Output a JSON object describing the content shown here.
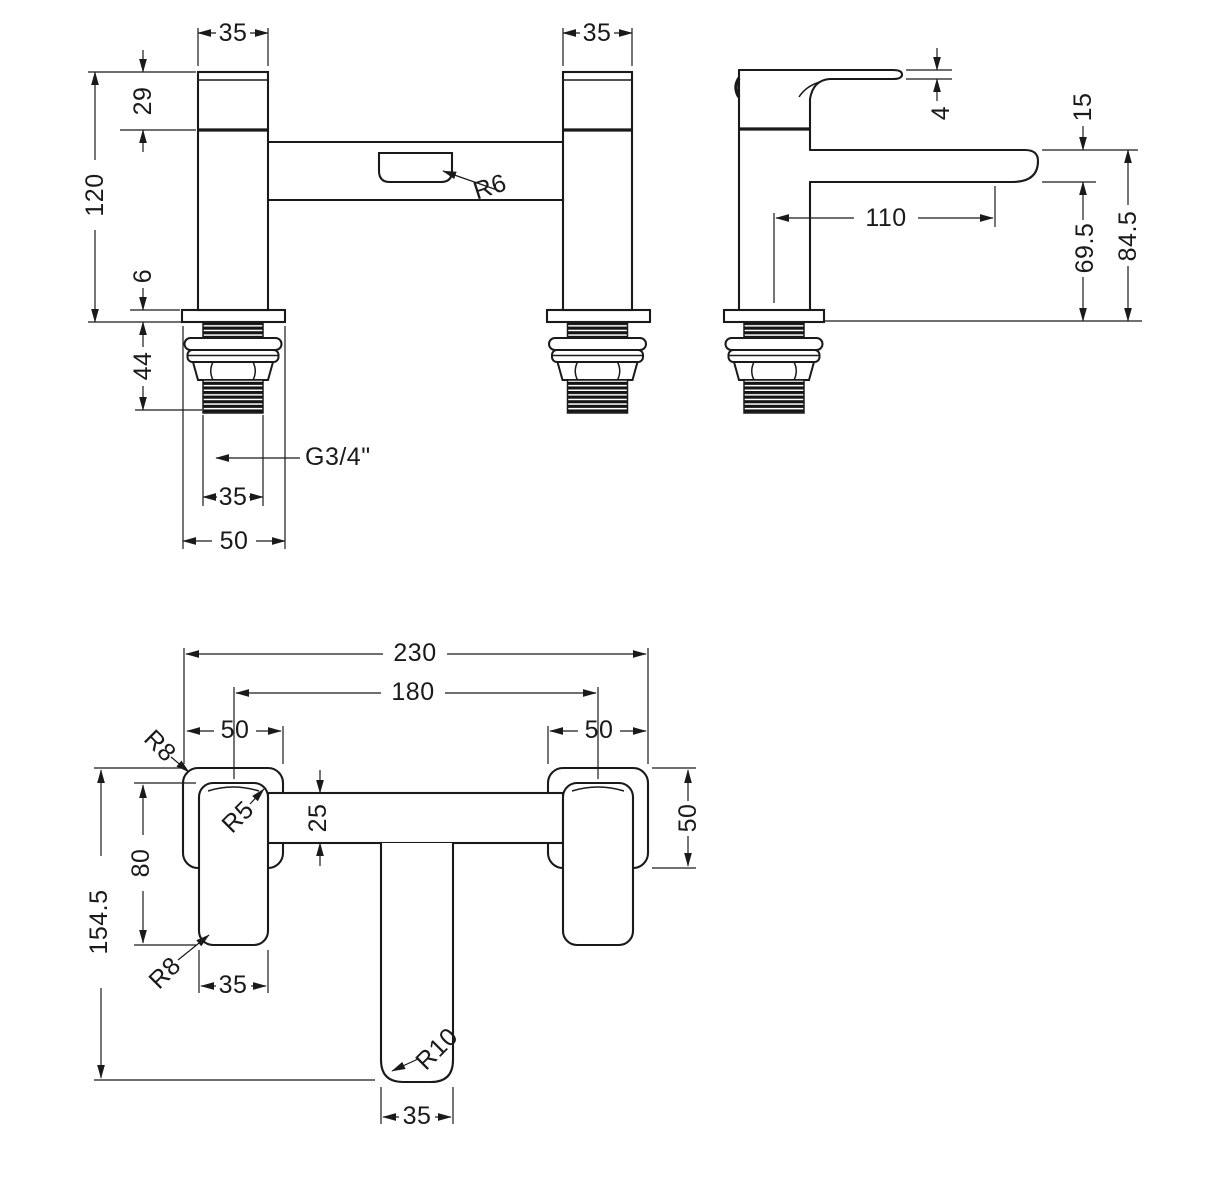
{
  "colors": {
    "ink": "#1a1a1a",
    "paper": "#ffffff"
  },
  "front": {
    "w_left": "35",
    "w_right": "35",
    "h_handle": "29",
    "h_body": "120",
    "t_flange": "6",
    "l_tail": "44",
    "thread_spec": "G3/4\"",
    "w_thread": "35",
    "w_flange": "50",
    "r_slot": "R6"
  },
  "side": {
    "t_handle": "4",
    "h_spout": "15",
    "reach": "110",
    "h_spout_to_deck": "69.5",
    "h_overall": "84.5"
  },
  "plan": {
    "w_overall": "230",
    "w_centres": "180",
    "w_flange_left": "50",
    "w_flange_right": "50",
    "d_flange": "50",
    "w_bar": "25",
    "l_handle": "80",
    "d_overall": "154.5",
    "w_handle": "35",
    "w_spout": "35",
    "r_flange": "R8",
    "r_bar": "R5",
    "r_handle": "R8",
    "r_spout": "R10"
  }
}
